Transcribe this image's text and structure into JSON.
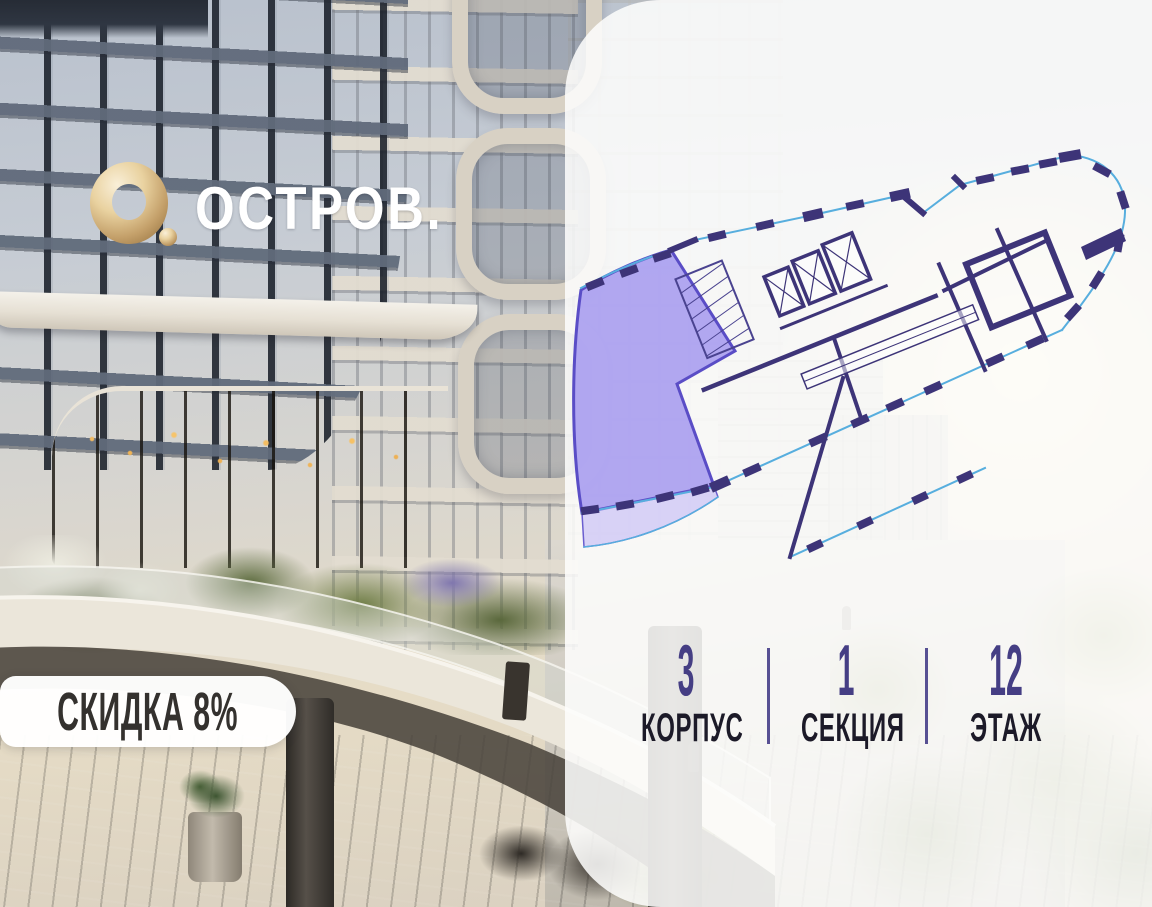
{
  "brand": {
    "wordmark": "ОСТРОВ.",
    "mark_icon": "gold-ring-with-dot",
    "gold_color": "#d9b87c",
    "text_color": "#ffffff"
  },
  "discount_badge": {
    "label": "СКИДКА 8%",
    "bg_color": "#ffffff",
    "text_color": "#34312e"
  },
  "unit_info": {
    "stats": [
      {
        "value": "3",
        "label": "КОРПУС"
      },
      {
        "value": "1",
        "label": "СЕКЦИЯ"
      },
      {
        "value": "12",
        "label": "ЭТАЖ"
      }
    ],
    "number_color": "#453e84",
    "label_color": "#1c1a28",
    "divider_color": "#575093"
  },
  "floor_plan": {
    "type": "residential-floor-plan",
    "highlighted_unit": "corner-apartment-left-end",
    "colors": {
      "highlight_fill": "#a99df0",
      "highlight_stroke": "#5a4dc6",
      "walls": "#3d3478",
      "facade_line": "#57aede",
      "balcony_fill": "#beb3f5"
    }
  },
  "panel": {
    "bg": "rgba(253,253,252,0.87)"
  }
}
